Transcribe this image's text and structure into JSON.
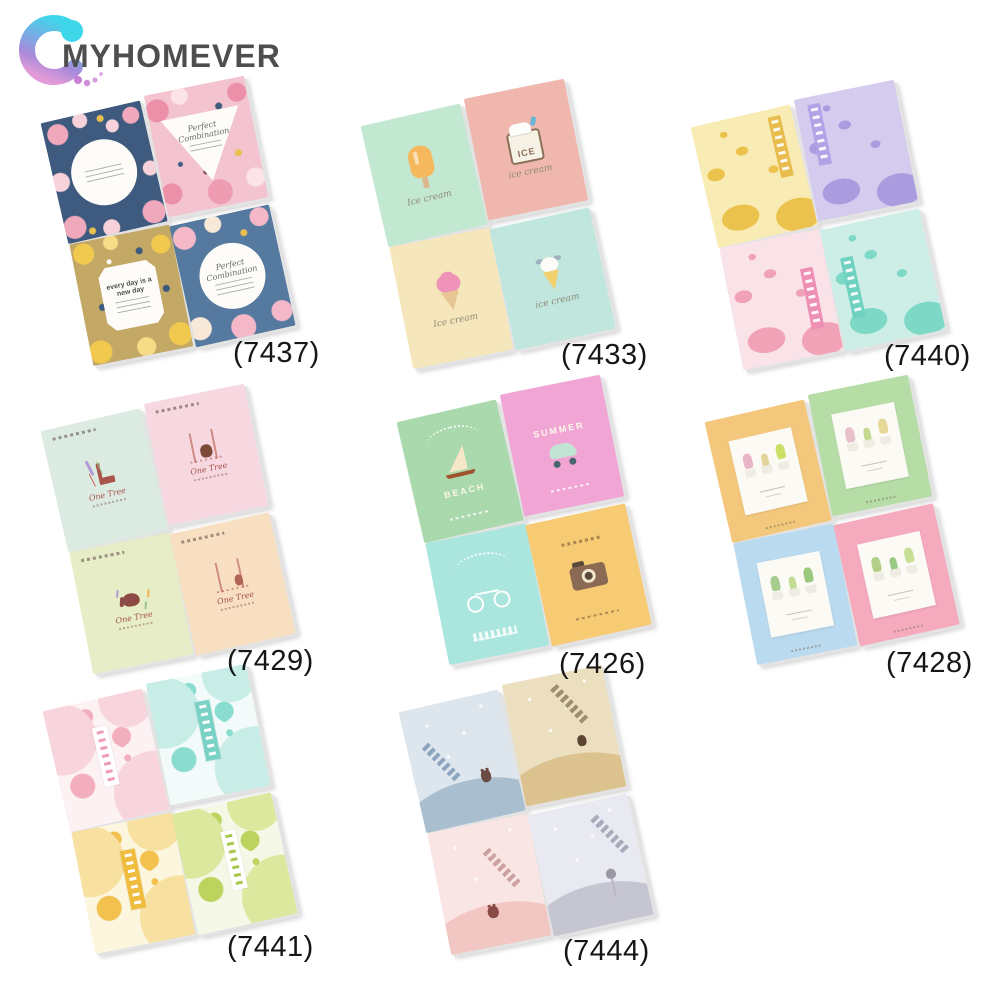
{
  "brand": {
    "name": "MYHOMEVER",
    "text_color": "#4e4e4e",
    "swirl_colors": [
      "#3fd6ea",
      "#7fa8e4",
      "#a88ada",
      "#e19ad8"
    ],
    "dot_color": "#c77fd4"
  },
  "groups": [
    {
      "code": "(7437)",
      "theme": "floral cover notebooks",
      "cards": [
        {
          "design": "floral-navy",
          "bg": "#3e5a7e",
          "shape": "circle",
          "caption": ""
        },
        {
          "design": "floral-pink",
          "bg": "#f3c4cf",
          "shape": "triangle",
          "caption": "Perfect Combination"
        },
        {
          "design": "floral-khaki",
          "bg": "#c4a866",
          "shape": "badge",
          "caption": "every day is a new day"
        },
        {
          "design": "floral-blue",
          "bg": "#56799f",
          "shape": "circle",
          "caption": "Perfect Combination"
        }
      ]
    },
    {
      "code": "(7433)",
      "theme": "ice cream notebooks",
      "cards": [
        {
          "design": "ice",
          "bg": "#c3e8d2",
          "icon": "popsicle",
          "caption": "Ice cream"
        },
        {
          "design": "ice",
          "bg": "#f0b7af",
          "icon": "icebox",
          "icon_text": "ICE",
          "caption": "ice cream"
        },
        {
          "design": "ice",
          "bg": "#f6e6bb",
          "icon": "softserve",
          "caption": "Ice cream"
        },
        {
          "design": "ice",
          "bg": "#c0e6de",
          "icon": "cone-ears",
          "caption": "ice cream"
        }
      ]
    },
    {
      "code": "(7440)",
      "theme": "silhouette pattern notebooks",
      "cards": [
        {
          "design": "pattern pstrip-tr",
          "bg": "#f8ecb4",
          "motif": "butterflies",
          "vars": {
            "accent": "#ecc24e",
            "strip": "#e9bc4e"
          }
        },
        {
          "design": "pattern pstrip-tl",
          "bg": "#d5cbee",
          "motif": "petals",
          "vars": {
            "accent": "#ab9ce0",
            "strip": "#b2a2e6"
          }
        },
        {
          "design": "pattern pstrip-rc",
          "bg": "#f9e2e8",
          "motif": "birds",
          "vars": {
            "accent": "#f2a2b6",
            "strip": "#ee8fb4"
          }
        },
        {
          "design": "pattern pstrip-lc",
          "bg": "#cdeee6",
          "motif": "dragonflies",
          "vars": {
            "accent": "#7ed8c6",
            "strip": "#6fd2c0"
          }
        }
      ]
    },
    {
      "code": "(7429)",
      "theme": "forest animal notebooks",
      "cards": [
        {
          "design": "forest",
          "bg": "#dcebe2",
          "icon": "giraffe",
          "caption": "One Tree"
        },
        {
          "design": "forest",
          "bg": "#f8d8e0",
          "icon": "bear-trees",
          "caption": "One Tree"
        },
        {
          "design": "forest",
          "bg": "#e7edc6",
          "icon": "elephant",
          "caption": "One Tree"
        },
        {
          "design": "forest",
          "bg": "#f8dfc2",
          "icon": "rabbit-trees",
          "caption": "One Tree"
        }
      ]
    },
    {
      "code": "(7426)",
      "theme": "summer travel notebooks",
      "cards": [
        {
          "design": "travel travel-beach",
          "bg": "#a9d9ac",
          "icon": "sailboat",
          "caption": "BEACH"
        },
        {
          "design": "travel travel-summer",
          "bg": "#f0a5d4",
          "icon": "scooter",
          "caption": "SUMMER"
        },
        {
          "design": "travel travel-island",
          "bg": "#abe6de",
          "icon": "bicycle",
          "caption": ""
        },
        {
          "design": "travel travel-camera",
          "bg": "#f7ca74",
          "icon": "camera",
          "caption": ""
        }
      ]
    },
    {
      "code": "(7428)",
      "theme": "potted plant notebooks",
      "cards": [
        {
          "design": "frame",
          "bg": "#f4c87c",
          "icon": "plants",
          "vars": {
            "plant": "#e8b4c8",
            "plant2": "#e4d49a",
            "plant3": "#cbe066"
          }
        },
        {
          "design": "frame",
          "bg": "#b6dda6",
          "icon": "plants",
          "vars": {
            "plant": "#e8c0cc",
            "plant2": "#c4d890",
            "plant3": "#e8d898"
          }
        },
        {
          "design": "frame",
          "bg": "#badaf0",
          "icon": "plants",
          "vars": {
            "plant": "#a8cc8e",
            "plant2": "#c2dc94",
            "plant3": "#9cc87e"
          }
        },
        {
          "design": "frame",
          "bg": "#f5aabe",
          "icon": "plants",
          "vars": {
            "plant": "#b2d088",
            "plant2": "#98c882",
            "plant3": "#c8e096"
          }
        }
      ]
    },
    {
      "code": "(7441)",
      "theme": "fruit pattern notebooks",
      "cards": [
        {
          "design": "fruit",
          "bg": "#fdf2f3",
          "motif": "strawberries",
          "vars": {
            "pale": "#f8d4dc",
            "accent": "#f3aebe",
            "strip": "#ffffff",
            "strip-dash": "#ef9cb4"
          }
        },
        {
          "design": "fruit",
          "bg": "#f2fbf9",
          "motif": "blueberries",
          "vars": {
            "pale": "#c8ece6",
            "accent": "#8adcd0",
            "strip": "#7ad2c6",
            "strip-dash": "#ffffff"
          }
        },
        {
          "design": "fruit",
          "bg": "#fdf6df",
          "motif": "lemons",
          "vars": {
            "pale": "#f8e0a0",
            "accent": "#f2c14e",
            "strip": "#f0bc3e",
            "strip-dash": "#ffffff"
          }
        },
        {
          "design": "fruit",
          "bg": "#f5f8e6",
          "motif": "kiwis",
          "vars": {
            "pale": "#dbe89e",
            "accent": "#bcd45e",
            "strip": "#ffffff",
            "strip-dash": "#a8c84e"
          }
        }
      ]
    },
    {
      "code": "(7444)",
      "theme": "little animal scene notebooks",
      "cards": [
        {
          "design": "scene scene-a",
          "bg": "#dde6ec",
          "icon": "cat",
          "vars": {
            "hill": "#a9bfd0",
            "ink": "#7a93b2"
          }
        },
        {
          "design": "scene scene-b",
          "bg": "#ecdfc0",
          "icon": "bird",
          "vars": {
            "hill": "#dcc28e",
            "ink": "#8a7a5a"
          }
        },
        {
          "design": "scene scene-c",
          "bg": "#f9e6e4",
          "icon": "bear",
          "vars": {
            "hill": "#f2c6c2",
            "ink": "#c09090"
          }
        },
        {
          "design": "scene scene-d",
          "bg": "#e9e9f1",
          "icon": "owl",
          "vars": {
            "hill": "#c6c6d2",
            "ink": "#9a9ab0"
          }
        }
      ]
    }
  ]
}
